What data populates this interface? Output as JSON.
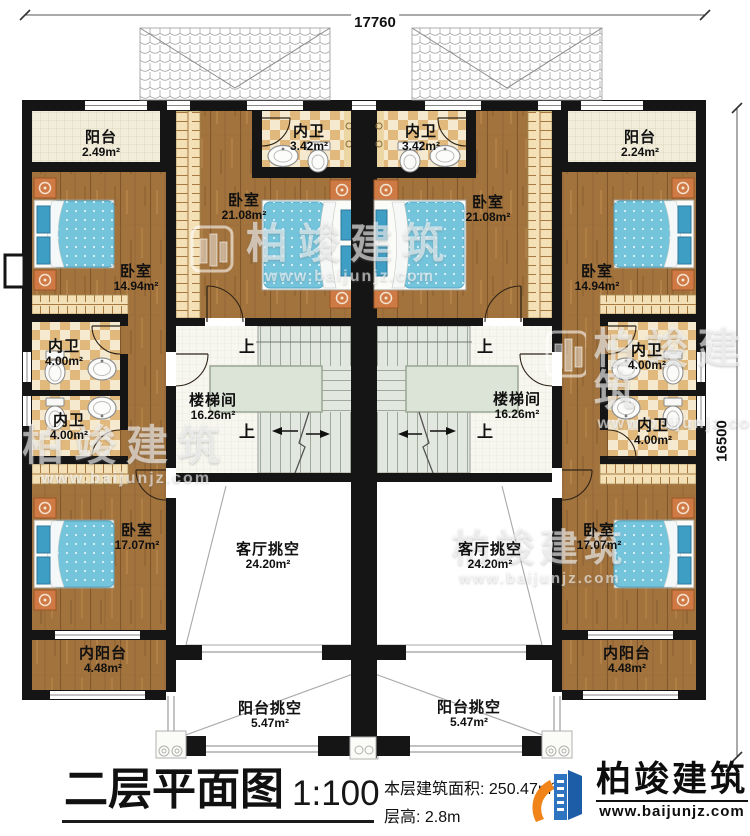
{
  "dimensions": {
    "width_label": "17760",
    "height_label": "16500"
  },
  "rooms": [
    {
      "name": "阳台",
      "area": "2.49m²"
    },
    {
      "name": "内卫",
      "area": "3.42m²"
    },
    {
      "name": "内卫",
      "area": "3.42m²"
    },
    {
      "name": "阳台",
      "area": "2.24m²"
    },
    {
      "name": "卧室",
      "area": "21.08m²"
    },
    {
      "name": "卧室",
      "area": "21.08m²"
    },
    {
      "name": "卧室",
      "area": "14.94m²"
    },
    {
      "name": "卧室",
      "area": "14.94m²"
    },
    {
      "name": "内卫",
      "area": "4.00m²"
    },
    {
      "name": "内卫",
      "area": "4.00m²"
    },
    {
      "name": "内卫",
      "area": "4.00m²"
    },
    {
      "name": "内卫",
      "area": "4.00m²"
    },
    {
      "name": "楼梯间",
      "area": "16.26m²"
    },
    {
      "name": "楼梯间",
      "area": "16.26m²"
    },
    {
      "name": "卧室",
      "area": "17.07m²"
    },
    {
      "name": "卧室",
      "area": "17.07m²"
    },
    {
      "name": "客厅挑空",
      "area": "24.20m²"
    },
    {
      "name": "客厅挑空",
      "area": "24.20m²"
    },
    {
      "name": "内阳台",
      "area": "4.48m²"
    },
    {
      "name": "内阳台",
      "area": "4.48m²"
    },
    {
      "name": "阳台挑空",
      "area": "5.47m²"
    },
    {
      "name": "阳台挑空",
      "area": "5.47m²"
    }
  ],
  "stairs": {
    "up_label": "上"
  },
  "title_block": {
    "title": "二层平面图",
    "scale": "1:100",
    "area_label": "本层建筑面积:",
    "area_value": "250.47m²",
    "floor_height_label": "层高:",
    "floor_height_value": "2.8m"
  },
  "logo": {
    "name": "柏竣建筑",
    "url": "www.baijunjz.com"
  },
  "watermark": {
    "name": "柏竣建筑",
    "url": "www.baijunjz.com"
  },
  "colors": {
    "wall": "#151515",
    "wood_floor": "#a2733d",
    "tile_checker": "#e2b97c",
    "bed_blue": "#74c4dc",
    "logo_blue": "#1d5ca6",
    "logo_orange": "#f08418"
  }
}
